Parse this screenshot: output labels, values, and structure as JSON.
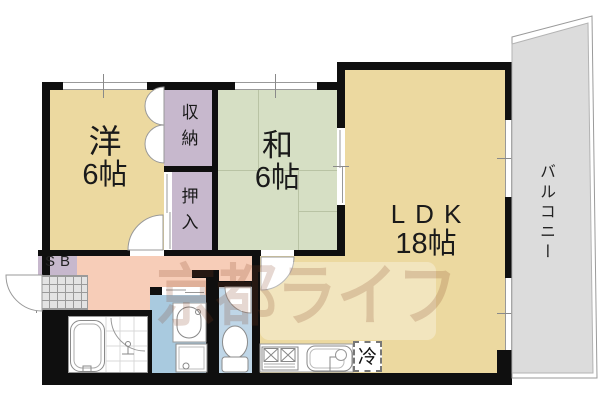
{
  "rooms": {
    "western": {
      "label": "洋",
      "size": "6帖"
    },
    "japanese": {
      "label": "和",
      "size": "6帖"
    },
    "ldk": {
      "label": "LDK",
      "size": "18帖"
    },
    "storage": {
      "label": "収納"
    },
    "oshiire": {
      "label": "押入"
    },
    "balcony": {
      "label": "バルコニー"
    },
    "shoe_box": {
      "label": "SB"
    },
    "refrigerator": {
      "label": "冷"
    }
  },
  "watermark": {
    "text": "京都ライフ"
  },
  "colors": {
    "western": "#ECD9A0",
    "ldk": "#ECD9A0",
    "japanese": "#D6DFC4",
    "closet": "#C7B8CD",
    "hallway": "#F7CDB8",
    "washroom": "#A9CADF",
    "toilet": "#BFD6E7",
    "balcony": "#DCDCDC",
    "genkan": "#E3E3E3",
    "wall": "#0F0F0F"
  }
}
